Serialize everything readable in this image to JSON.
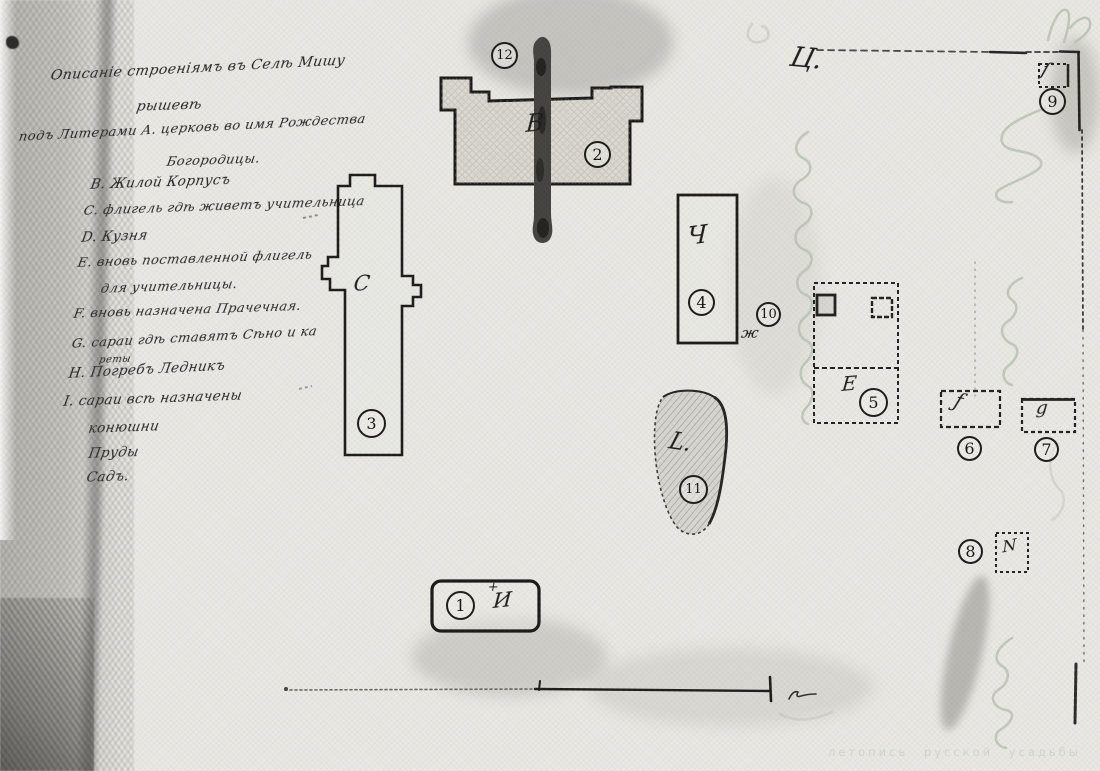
{
  "page": {
    "width": 1100,
    "height": 771,
    "kind": "scanned hand-drawn estate plan"
  },
  "colors": {
    "ink": "#1d1c1a",
    "paper": "#e9e8e3",
    "road": "#45433f",
    "showthrough": "#b9c3b4",
    "watermark": "#cbd5c9"
  },
  "watermark": {
    "text": "летопись русской усадьбы"
  },
  "legend": {
    "lines": [
      {
        "text": "Описаніе строеніямъ въ Селѣ Мишу",
        "x": 52,
        "y": 68,
        "size": 14,
        "rot": -3
      },
      {
        "text": "рышевѣ",
        "x": 138,
        "y": 99,
        "size": 14,
        "rot": -2
      },
      {
        "text": "подъ Литерами А. церковь во имя Рождества",
        "x": 20,
        "y": 130,
        "size": 13,
        "rot": -3
      },
      {
        "text": "Богородицы.",
        "x": 168,
        "y": 155,
        "size": 13,
        "rot": -2
      },
      {
        "text": "В. Жилой Корпусъ",
        "x": 92,
        "y": 177,
        "size": 13.5,
        "rot": -2
      },
      {
        "text": "С. флигель гдѣ живетъ учительница",
        "x": 85,
        "y": 204,
        "size": 13,
        "rot": -2
      },
      {
        "text": "D. Кузня",
        "x": 83,
        "y": 230,
        "size": 13.5,
        "rot": -2
      },
      {
        "text": "Е. вновь поставленной флигель",
        "x": 79,
        "y": 256,
        "size": 13,
        "rot": -2
      },
      {
        "text": "для учительницы.",
        "x": 102,
        "y": 282,
        "size": 13,
        "rot": -2
      },
      {
        "text": "F. вновь назначена Прачечная.",
        "x": 75,
        "y": 307,
        "size": 13,
        "rot": -2
      },
      {
        "text": "G. сараи гдѣ ставятъ Сѣно и ка",
        "x": 73,
        "y": 337,
        "size": 13,
        "rot": -3
      },
      {
        "text": "реты",
        "x": 100,
        "y": 355,
        "size": 10,
        "rot": -2
      },
      {
        "text": "Н. Погребъ Ледникъ",
        "x": 70,
        "y": 366,
        "size": 13.5,
        "rot": -3
      },
      {
        "text": "I. сараи всѣ назначены",
        "x": 65,
        "y": 394,
        "size": 13.5,
        "rot": -2
      },
      {
        "text": "конюшни",
        "x": 90,
        "y": 421,
        "size": 13.5,
        "rot": -2
      },
      {
        "text": "Пруды",
        "x": 90,
        "y": 446,
        "size": 13.5,
        "rot": -2
      },
      {
        "text": "Садъ.",
        "x": 88,
        "y": 470,
        "size": 13.5,
        "rot": -2
      }
    ]
  },
  "markers": [
    {
      "n": "1",
      "x": 461,
      "y": 606,
      "r": 15
    },
    {
      "n": "2",
      "x": 598,
      "y": 155,
      "r": 14
    },
    {
      "n": "3",
      "x": 372,
      "y": 424,
      "r": 15
    },
    {
      "n": "4",
      "x": 702,
      "y": 303,
      "r": 14
    },
    {
      "n": "5",
      "x": 874,
      "y": 403,
      "r": 15
    },
    {
      "n": "6",
      "x": 970,
      "y": 449,
      "r": 13
    },
    {
      "n": "7",
      "x": 1047,
      "y": 450,
      "r": 13
    },
    {
      "n": "8",
      "x": 971,
      "y": 552,
      "r": 13
    },
    {
      "n": "9",
      "x": 1053,
      "y": 102,
      "r": 14
    },
    {
      "n": "10",
      "x": 769,
      "y": 315,
      "r": 13
    },
    {
      "n": "11",
      "x": 694,
      "y": 490,
      "r": 15
    },
    {
      "n": "12",
      "x": 505,
      "y": 56,
      "r": 14
    }
  ],
  "letters": [
    {
      "ch": "+",
      "x": 489,
      "y": 580,
      "size": 13,
      "rot": 0
    },
    {
      "ch": "И",
      "x": 494,
      "y": 589,
      "size": 21,
      "rot": -6
    },
    {
      "ch": "В",
      "x": 527,
      "y": 110,
      "size": 24,
      "rot": -6
    },
    {
      "ch": "С",
      "x": 355,
      "y": 272,
      "size": 21,
      "rot": -4
    },
    {
      "ch": "Ч",
      "x": 688,
      "y": 222,
      "size": 25,
      "rot": -8
    },
    {
      "ch": "Е",
      "x": 843,
      "y": 372,
      "size": 20,
      "rot": -5
    },
    {
      "ch": "ƒ",
      "x": 960,
      "y": 388,
      "size": 20,
      "rot": 12
    },
    {
      "ch": "g",
      "x": 1037,
      "y": 398,
      "size": 18,
      "rot": -5
    },
    {
      "ch": "N",
      "x": 1002,
      "y": 538,
      "size": 16,
      "rot": -12
    },
    {
      "ch": "ſ",
      "x": 1046,
      "y": 58,
      "size": 19,
      "rot": 10
    },
    {
      "ch": "ж",
      "x": 743,
      "y": 324,
      "size": 15,
      "rot": 0
    },
    {
      "ch": "L.",
      "x": 674,
      "y": 428,
      "size": 23,
      "rot": 8
    },
    {
      "ch": "Ц.",
      "x": 795,
      "y": 42,
      "size": 27,
      "rot": 5
    }
  ]
}
